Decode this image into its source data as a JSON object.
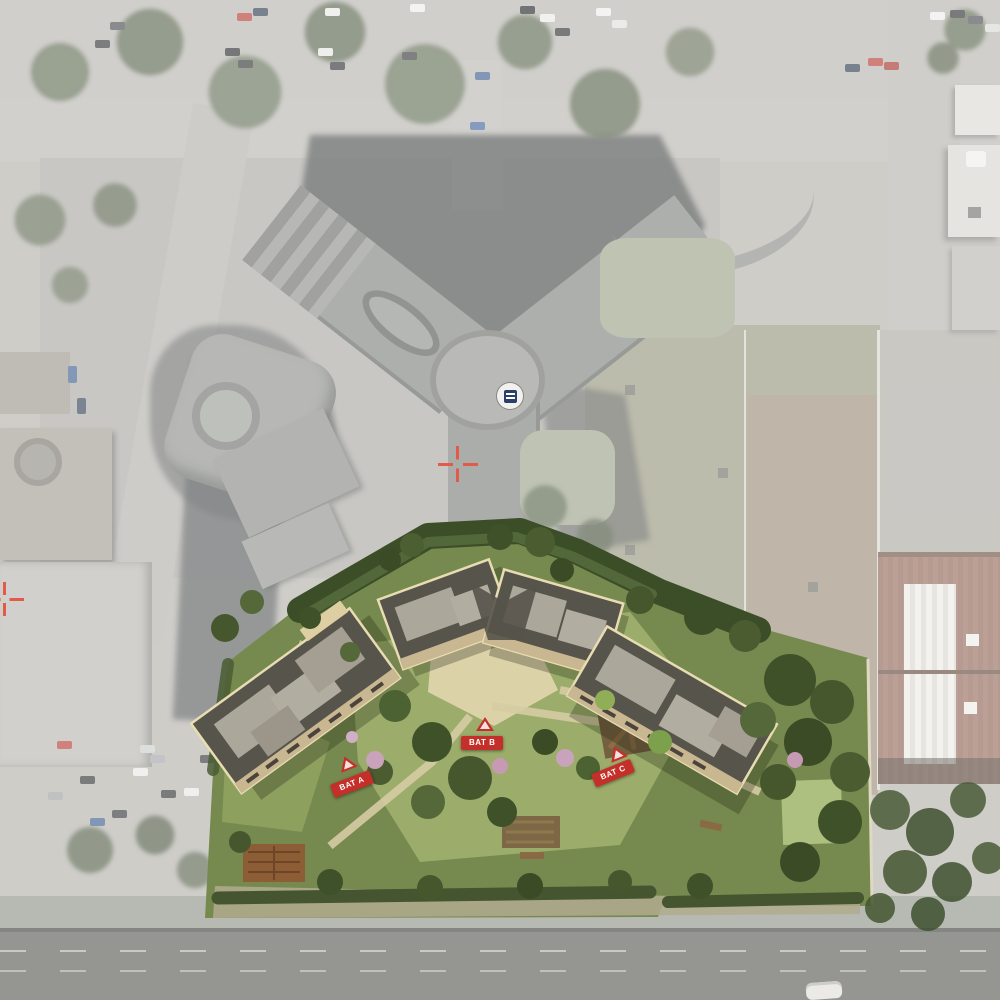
{
  "scene": {
    "type": "aerial-site-plan",
    "description": "Satellite aerial photo with white haze overlay; a vivid architectural render of a three-building residential project with gardens is superimposed on the southern part of the site, beside a Y-shaped existing building complex."
  },
  "markers": {
    "bat_a": {
      "label": "BAT A"
    },
    "bat_b": {
      "label": "BAT B"
    },
    "bat_c": {
      "label": "BAT C"
    }
  },
  "annotations": {
    "survey_cross_center": "registration-cross",
    "survey_cross_left_edge": "registration-cross",
    "roundabout_sign": "round-building-sign"
  },
  "colors": {
    "marker_red": "#c43029",
    "marker_text": "#ffffff",
    "cross_red": "#e25a4a",
    "sign_navy": "#2c3f6b",
    "render_lawn_green": "#9cad6b",
    "render_tree_green": "#46572e",
    "roof_light_gray": "#aca79b",
    "roof_dark_band": "#57544c",
    "roof_edge_cream": "#e8dcb2",
    "asphalt_gray": "#b2b0a9",
    "road_dark": "#575953",
    "warehouse_rust": "#8b6152",
    "haze_white": "#ffffff"
  }
}
